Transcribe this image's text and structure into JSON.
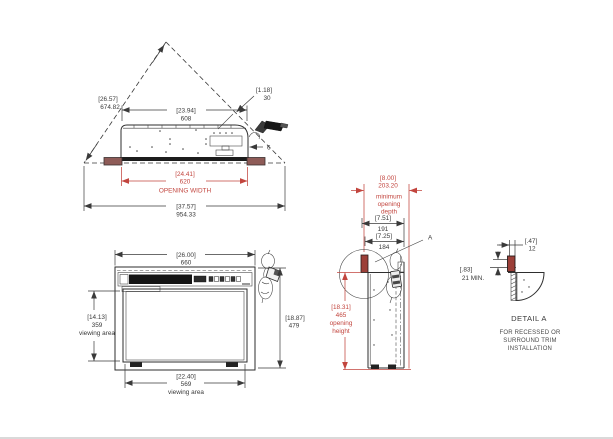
{
  "page": {
    "background": "#ffffff"
  },
  "colors": {
    "dimension_red": "#c2453e",
    "flange_maroon": "#8e5b57",
    "trim_red": "#9c3f38",
    "line_dark": "#2e2e2e"
  },
  "views": {
    "top": {
      "diagonal_dim_in": "[26.57]",
      "diagonal_dim_mm": "674.82",
      "offset_dim_in": "[1.18]",
      "offset_dim_mm": "30",
      "unit_width_in": "[23.94]",
      "unit_width_mm": "608",
      "opening_width_in": "[24.41]",
      "opening_width_mm": "620",
      "opening_width_label": "OPENING WIDTH",
      "overall_in": "[37.57]",
      "overall_mm": "954.33",
      "corner_mark": "6"
    },
    "front": {
      "width_in": "[26.00]",
      "width_mm": "660",
      "view_h_in": "[14.13]",
      "view_h_mm": "359",
      "view_h_label": "viewing area",
      "height_in": "[18.87]",
      "height_mm": "479",
      "view_w_in": "[22.40]",
      "view_w_mm": "569",
      "view_w_label": "viewing area"
    },
    "side": {
      "depth_in": "[8.00]",
      "depth_mm": "203.20",
      "depth_l1": "minimum",
      "depth_l2": "opening",
      "depth_l3": "depth",
      "d1_in": "[7.51]",
      "d1_mm": "191",
      "d2_in": "[7.25]",
      "d2_mm": "184",
      "height_in": "[18.31]",
      "height_mm": "465",
      "height_l1": "opening",
      "height_l2": "height",
      "detail_label": "A"
    },
    "detail": {
      "trim_in": "[.47]",
      "trim_mm": "12",
      "clear_in": "[.83]",
      "clear_mm": "21 MIN.",
      "title": "DETAIL A",
      "note1": "FOR RECESSED OR",
      "note2": "SURROUND TRIM",
      "note3": "INSTALLATION"
    }
  }
}
